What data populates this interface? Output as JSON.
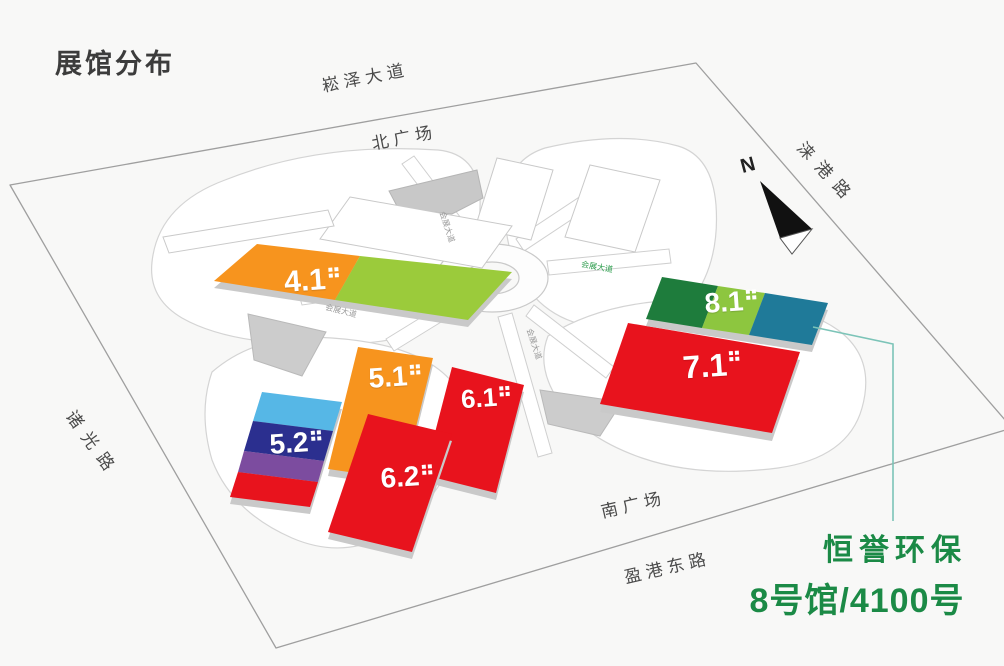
{
  "title": "展馆分布",
  "roads": {
    "north": "崧泽大道",
    "north_plaza": "北广场",
    "east": "涞港路",
    "west": "诸光路",
    "south_plaza": "南广场",
    "south": "盈港东路"
  },
  "inner_road_labels": [
    "会展大道",
    "会展大道",
    "会展大道",
    "会展大道"
  ],
  "compass": {
    "n": "N"
  },
  "halls": [
    {
      "label": "4.1",
      "colors": [
        "#F7941E",
        "#9BCB3B"
      ]
    },
    {
      "label": "5.1",
      "colors": [
        "#F7941E"
      ]
    },
    {
      "label": "5.2",
      "colors": [
        "#56B7E6",
        "#2B2F8F",
        "#7C4C9F",
        "#E8131D"
      ]
    },
    {
      "label": "6.1",
      "colors": [
        "#E8131D"
      ]
    },
    {
      "label": "6.2",
      "colors": [
        "#E8131D"
      ]
    },
    {
      "label": "7.1",
      "colors": [
        "#E8131D"
      ]
    },
    {
      "label": "8.1",
      "colors": [
        "#1E7C3C",
        "#8DC63F",
        "#1F7A99"
      ]
    }
  ],
  "annotation": {
    "line1": "恒誉环保",
    "line2": "8号馆/4100号",
    "color": "#1B8A46",
    "callout_color": "#7CC4B8"
  }
}
